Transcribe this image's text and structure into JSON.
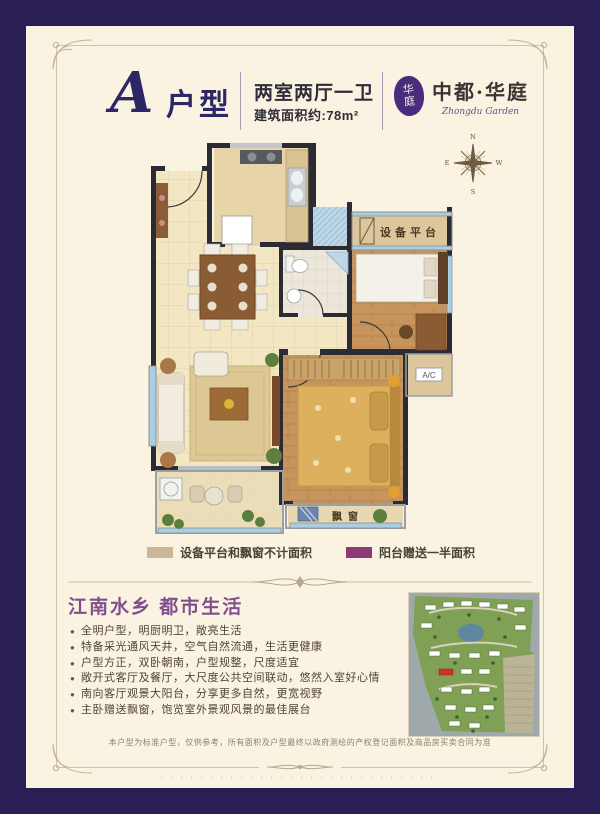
{
  "colors": {
    "frame_navy": "#2a1e55",
    "paper": "#fbf3e1",
    "accent_purple": "#80508d",
    "legend_tan": "#c9b798",
    "legend_purple": "#8e3a7a"
  },
  "header": {
    "type_letter": "A",
    "type_word": "户型",
    "rooms": "两室两厅一卫",
    "area": "建筑面积约:78m²",
    "logo_seal_top": "华",
    "logo_seal_bottom": "庭",
    "logo_name": "中都·华庭",
    "logo_name_en": "Zhongdu Garden"
  },
  "compass": {
    "north": "N",
    "east": "E",
    "south": "S",
    "west": "W"
  },
  "plan": {
    "label_equipment": "设备平台",
    "label_ac": "A/C",
    "label_bay_window": "飘窗"
  },
  "legend": {
    "item1": "设备平台和飘窗不计面积",
    "item2": "阳台赠送一半面积"
  },
  "features": {
    "title": "江南水乡  都市生活",
    "bullets": [
      "全明户型，明厨明卫，敞亮生活",
      "特备采光通风天井，空气自然流通，生活更健康",
      "户型方正，双卧朝南，户型规整，尺度适宜",
      "敞开式客厅及餐厅，大尺度公共空间联动，悠然入室好心情",
      "南向客厅观景大阳台，分享更多自然，更宽视野",
      "主卧赠送飘窗，饱览室外景观风景的最佳展台"
    ]
  },
  "footer": {
    "disclaimer": "本户型为标准户型，仅供参考，所有面积及户型最终以政府测绘的产权登记面积及商品房买卖合同为准",
    "dots": "····························"
  }
}
